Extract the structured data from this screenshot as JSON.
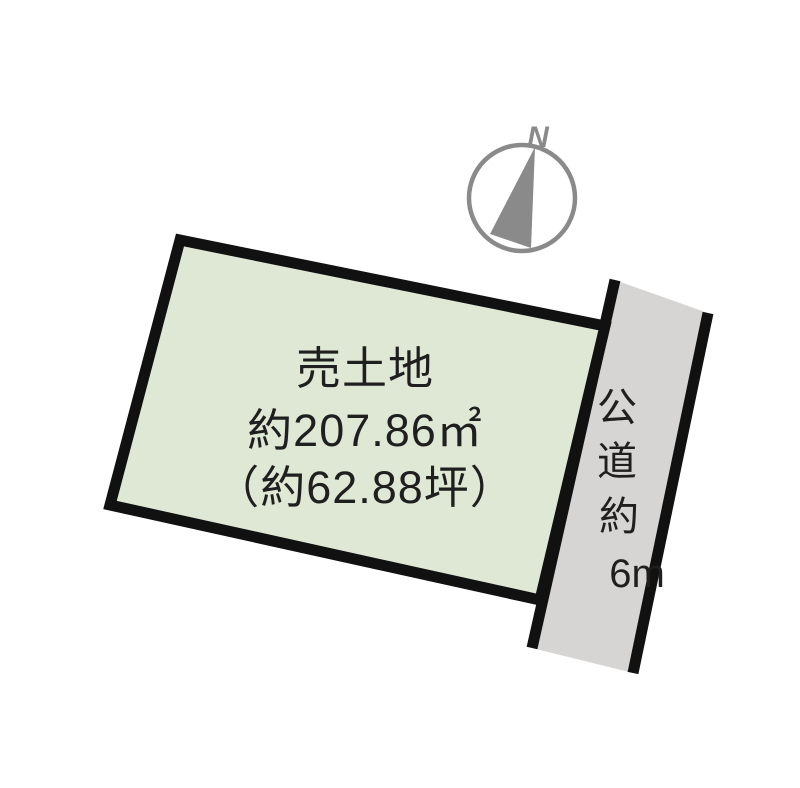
{
  "diagram": {
    "plot": {
      "label_lines": [
        "売土地",
        "約207.86㎡",
        "（約62.88坪）"
      ]
    },
    "road": {
      "label_chars": [
        "公",
        "道",
        "約",
        "6m"
      ]
    },
    "compass": {
      "north_label": "N"
    },
    "colors": {
      "background": "#ffffff",
      "plot_fill": "#dfe8d4",
      "road_fill": "#d6d5d3",
      "outline": "#111111",
      "compass_gray": "#8a8a8a",
      "text": "#1f1f1f"
    }
  }
}
